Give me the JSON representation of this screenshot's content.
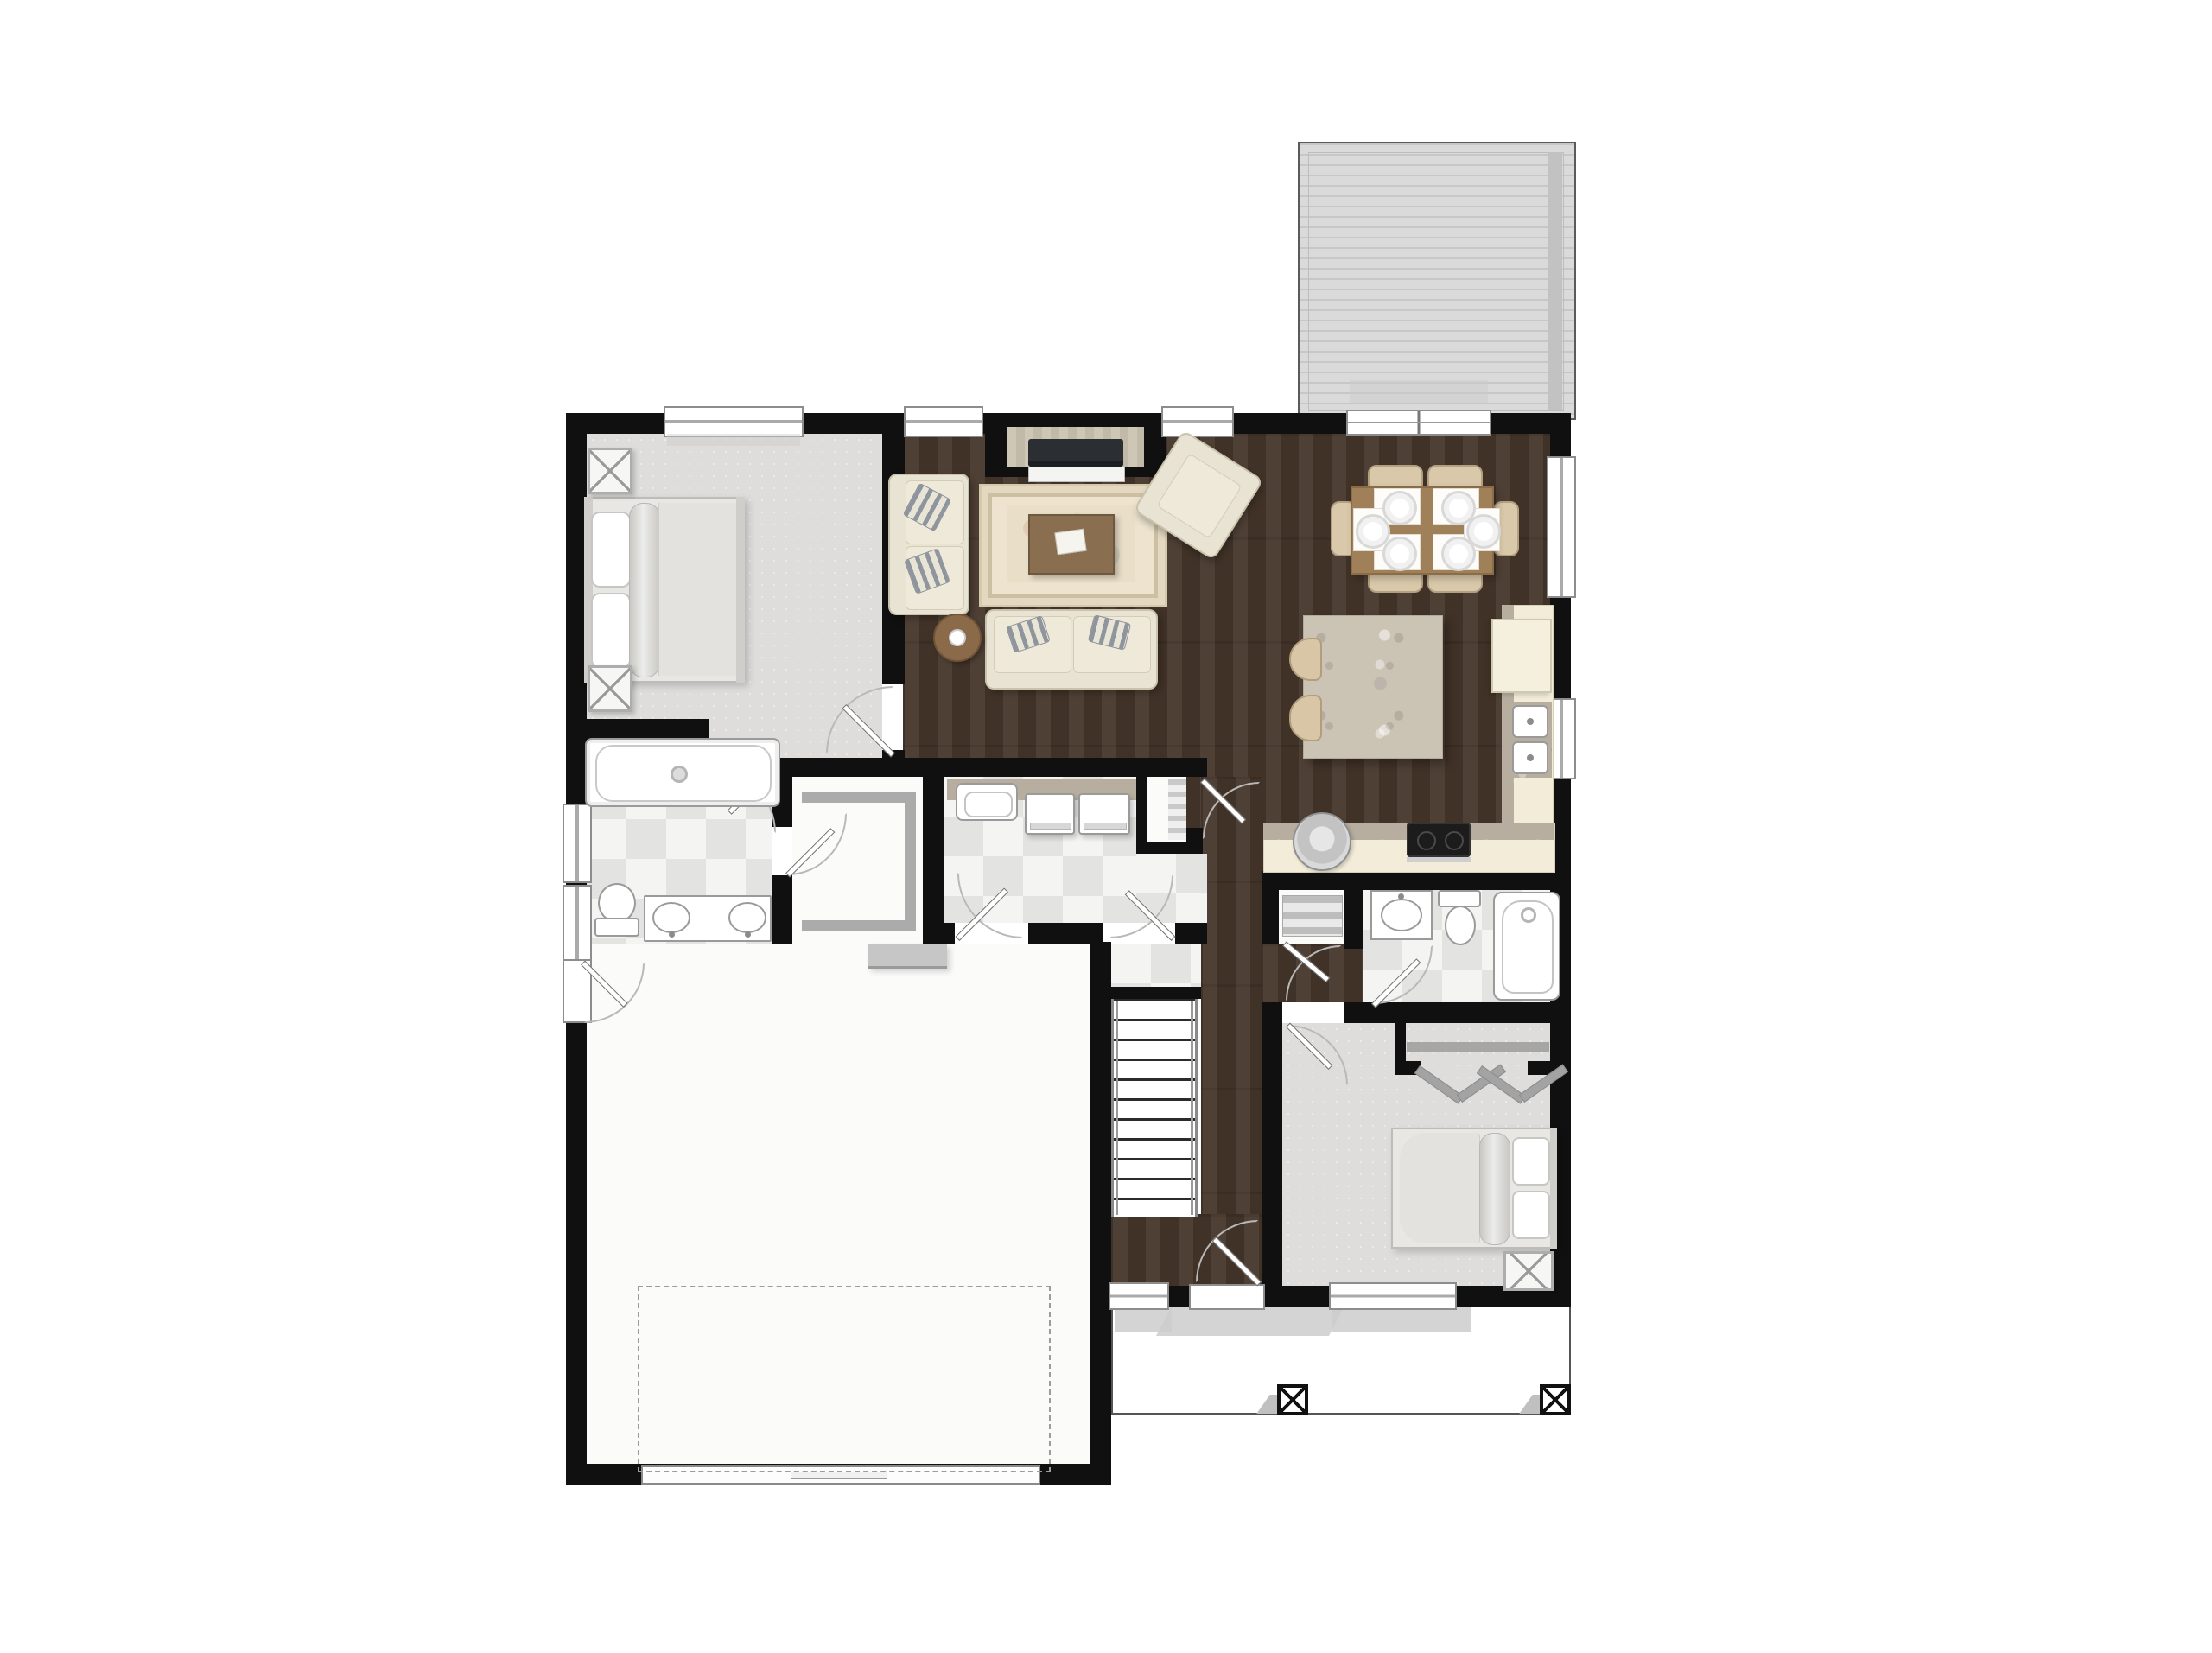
{
  "document": {
    "kind": "residential floor plan rendering",
    "view": "top-down furnished color plan, main level",
    "visible_text": "none"
  },
  "palette": {
    "wall": "#101010",
    "hardwood": "#46362a",
    "carpet": "#dedddb",
    "tile_checker_light": "#f4f4f3",
    "tile_checker_dark": "#e3e3e1",
    "deck_plank": "#d9d9d9",
    "granite": "#cbc3b4",
    "cabinet_cream": "#f2ecd8",
    "upholstery": "#e9e3d3",
    "rug_cream": "#ede3cf",
    "table_brown": "#9c7c55",
    "fixture_white": "#ffffff",
    "background": "#ffffff"
  },
  "rooms": [
    {
      "name": "master bedroom",
      "floor": "carpet",
      "furniture": [
        "king bed",
        "nightstand with X top",
        "nightstand with X top"
      ],
      "windows": 1,
      "doors": 1
    },
    {
      "name": "master bathroom",
      "floor": "checker tile",
      "furniture": [
        "soaking tub",
        "toilet",
        "double vanity with two oval sinks"
      ],
      "windows": 2
    },
    {
      "name": "walk-in closet",
      "floor": "light",
      "furniture": [
        "U-shaped shelving"
      ],
      "doors": 1
    },
    {
      "name": "laundry room",
      "floor": "checker tile",
      "furniture": [
        "counter with utility sink",
        "washer",
        "dryer"
      ],
      "doors": 2
    },
    {
      "name": "pantry",
      "floor": "light",
      "furniture": [
        "shelves"
      ],
      "doors": 1
    },
    {
      "name": "living room",
      "floor": "hardwood",
      "furniture": [
        "fireplace media alcove with TV",
        "area rug",
        "coffee table with book",
        "sofa",
        "loveseat",
        "accent chair",
        "round side table"
      ],
      "windows": 2
    },
    {
      "name": "dining area",
      "floor": "hardwood",
      "furniture": [
        "rectangular table",
        "6 chairs",
        "6 place settings"
      ],
      "windows": 2
    },
    {
      "name": "kitchen",
      "floor": "hardwood",
      "furniture": [
        "island with granite top",
        "2 stools",
        "L-shaped counter",
        "double sink",
        "cooktop",
        "refrigerator",
        "round corner appliance"
      ],
      "windows": 1
    },
    {
      "name": "stairs",
      "floor": "painted",
      "treads": 12,
      "rails": 2
    },
    {
      "name": "hallway",
      "floor": "hardwood"
    },
    {
      "name": "hall bathroom",
      "floor": "checker tile",
      "furniture": [
        "vanity with oval sink",
        "toilet",
        "bathtub"
      ],
      "doors": 1
    },
    {
      "name": "linen closet",
      "floor": "light",
      "furniture": [
        "shelf"
      ],
      "doors": 1
    },
    {
      "name": "bedroom 2",
      "floor": "carpet",
      "furniture": [
        "queen bed",
        "nightstand with X top",
        "closet with rod and bifold doors"
      ],
      "windows": 1,
      "doors": 1
    },
    {
      "name": "garage",
      "floor": "concrete white",
      "features": [
        "dashed parking stall outline",
        "overhead garage door",
        "side entry door",
        "entry step"
      ]
    },
    {
      "name": "foyer",
      "floor": "hardwood",
      "features": [
        "front door",
        "sidelite window"
      ]
    },
    {
      "name": "front porch",
      "floor": "white",
      "posts": 2
    },
    {
      "name": "rear deck",
      "floor": "gray planks",
      "features": [
        "sliding glass door"
      ]
    }
  ],
  "counts": {
    "bedrooms": 2,
    "bathrooms": 2,
    "dining_seats": 6,
    "dining_place_settings": 6,
    "kitchen_stools": 2,
    "stair_treads": 12,
    "porch_posts": 2,
    "garage_bays": 1
  },
  "icons": {
    "post-symbol": "square with X (structural column)",
    "nightstand-symbol": "square with X",
    "door-symbol": "leaf with quarter-circle swing arc"
  }
}
